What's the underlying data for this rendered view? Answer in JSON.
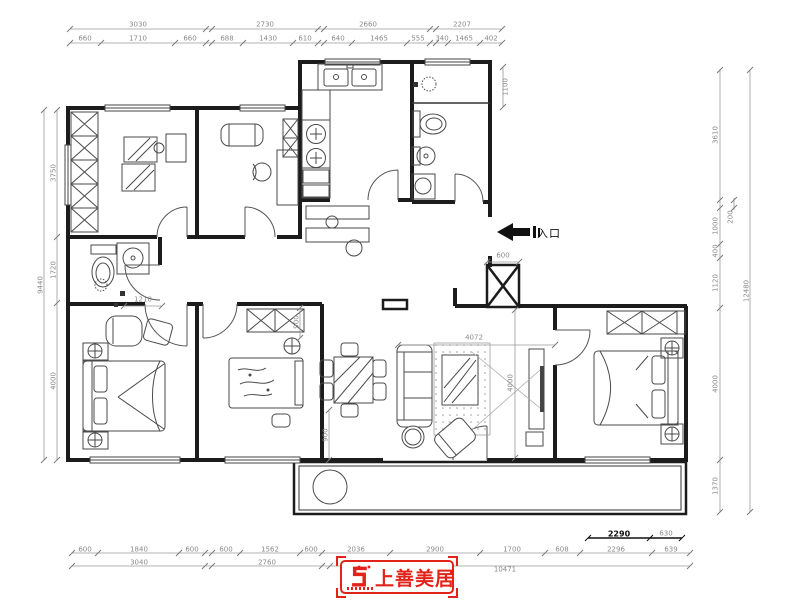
{
  "entrance": {
    "label": "入口"
  },
  "logo": {
    "text": "上善美居",
    "accent_color": "#e2231a"
  },
  "dims": [
    {
      "t": "3030",
      "x": 138,
      "y": 25
    },
    {
      "t": "2730",
      "x": 265,
      "y": 25
    },
    {
      "t": "2660",
      "x": 368,
      "y": 25
    },
    {
      "t": "2207",
      "x": 462,
      "y": 25
    },
    {
      "t": "660",
      "x": 85,
      "y": 39
    },
    {
      "t": "1710",
      "x": 138,
      "y": 39
    },
    {
      "t": "660",
      "x": 190,
      "y": 39
    },
    {
      "t": "688",
      "x": 227,
      "y": 39
    },
    {
      "t": "1430",
      "x": 268,
      "y": 39
    },
    {
      "t": "610",
      "x": 305,
      "y": 39
    },
    {
      "t": "640",
      "x": 338,
      "y": 39
    },
    {
      "t": "1465",
      "x": 379,
      "y": 39
    },
    {
      "t": "555",
      "x": 418,
      "y": 39
    },
    {
      "t": "340",
      "x": 442,
      "y": 39
    },
    {
      "t": "1465",
      "x": 464,
      "y": 39
    },
    {
      "t": "402",
      "x": 491,
      "y": 39
    },
    {
      "t": "3750",
      "x": 54,
      "y": 173,
      "r": 1
    },
    {
      "t": "1720",
      "x": 54,
      "y": 270,
      "r": 1
    },
    {
      "t": "4000",
      "x": 54,
      "y": 381,
      "r": 1
    },
    {
      "t": "9440",
      "x": 41,
      "y": 285,
      "r": 1
    },
    {
      "t": "3610",
      "x": 716,
      "y": 135,
      "r": 1
    },
    {
      "t": "200",
      "x": 731,
      "y": 217,
      "r": 1
    },
    {
      "t": "1000",
      "x": 716,
      "y": 226,
      "r": 1
    },
    {
      "t": "400",
      "x": 716,
      "y": 251,
      "r": 1
    },
    {
      "t": "1120",
      "x": 716,
      "y": 283,
      "r": 1
    },
    {
      "t": "4000",
      "x": 716,
      "y": 384,
      "r": 1
    },
    {
      "t": "1370",
      "x": 716,
      "y": 486,
      "r": 1
    },
    {
      "t": "12480",
      "x": 747,
      "y": 291,
      "r": 1
    },
    {
      "t": "600",
      "x": 85,
      "y": 550
    },
    {
      "t": "1840",
      "x": 139,
      "y": 550
    },
    {
      "t": "600",
      "x": 192,
      "y": 550
    },
    {
      "t": "600",
      "x": 226,
      "y": 550
    },
    {
      "t": "1562",
      "x": 270,
      "y": 550
    },
    {
      "t": "600",
      "x": 311,
      "y": 550
    },
    {
      "t": "2036",
      "x": 356,
      "y": 550
    },
    {
      "t": "2900",
      "x": 435,
      "y": 550
    },
    {
      "t": "1700",
      "x": 512,
      "y": 550
    },
    {
      "t": "608",
      "x": 562,
      "y": 550
    },
    {
      "t": "2296",
      "x": 616,
      "y": 550
    },
    {
      "t": "639",
      "x": 671,
      "y": 550
    },
    {
      "t": "3040",
      "x": 139,
      "y": 563
    },
    {
      "t": "2760",
      "x": 267,
      "y": 563
    },
    {
      "t": "10471",
      "x": 505,
      "y": 570
    },
    {
      "t": "2290",
      "x": 619,
      "y": 534,
      "b": 1
    },
    {
      "t": "630",
      "x": 666,
      "y": 534
    },
    {
      "t": "1100",
      "x": 506,
      "y": 87,
      "r": 1
    },
    {
      "t": "600",
      "x": 503,
      "y": 256
    },
    {
      "t": "1210",
      "x": 143,
      "y": 300
    },
    {
      "t": "900",
      "x": 297,
      "y": 322,
      "r": 1
    },
    {
      "t": "900",
      "x": 326,
      "y": 435,
      "r": 1
    },
    {
      "t": "4072",
      "x": 474,
      "y": 338
    },
    {
      "t": "4000",
      "x": 511,
      "y": 383,
      "r": 1
    }
  ]
}
